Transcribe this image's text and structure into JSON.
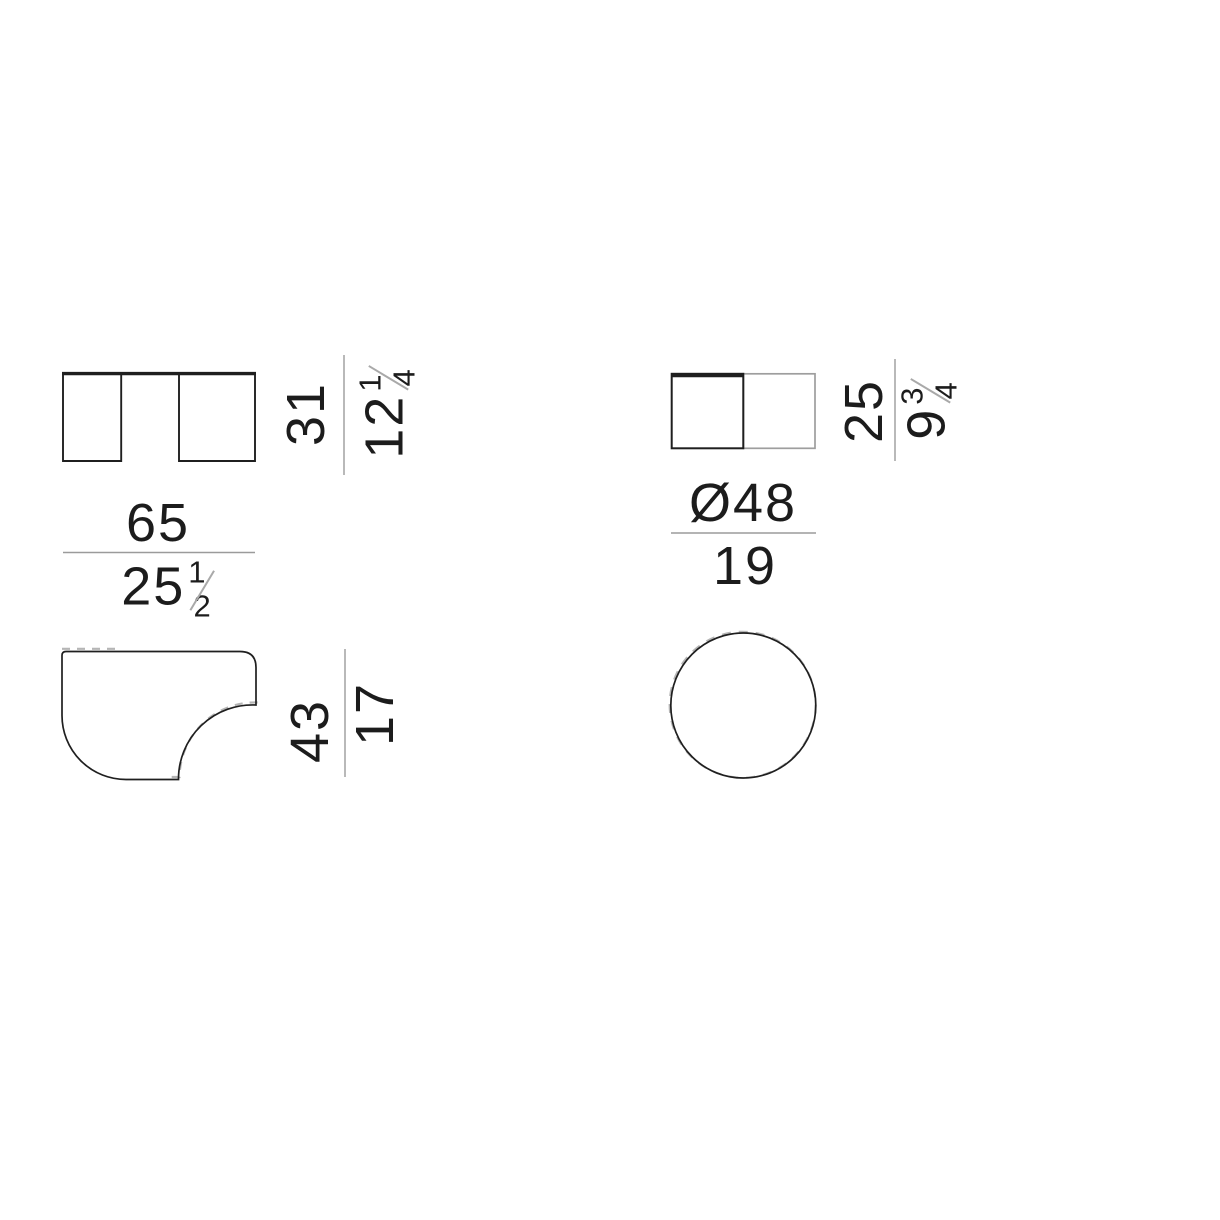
{
  "colors": {
    "background": "#ffffff",
    "outline": "#1f1f1f",
    "outline_light": "#9e9e9e",
    "dim_line": "#9b9b9b",
    "dashed": "#b5b5b5",
    "text": "#1c1c1c",
    "fraction_slash": "#a9a9a9"
  },
  "rect_table": {
    "height": {
      "cm": "31",
      "inches_whole": "12",
      "inches_numerator": "1",
      "inches_denominator": "4"
    },
    "width": {
      "cm": "65",
      "inches_whole": "25",
      "inches_numerator": "1",
      "inches_denominator": "2"
    },
    "depth": {
      "cm": "43",
      "inches": "17"
    }
  },
  "round_table": {
    "height": {
      "cm": "25",
      "inches_whole": "9",
      "inches_numerator": "3",
      "inches_denominator": "4"
    },
    "diameter": {
      "cm": "Ø48",
      "inches": "19"
    }
  }
}
